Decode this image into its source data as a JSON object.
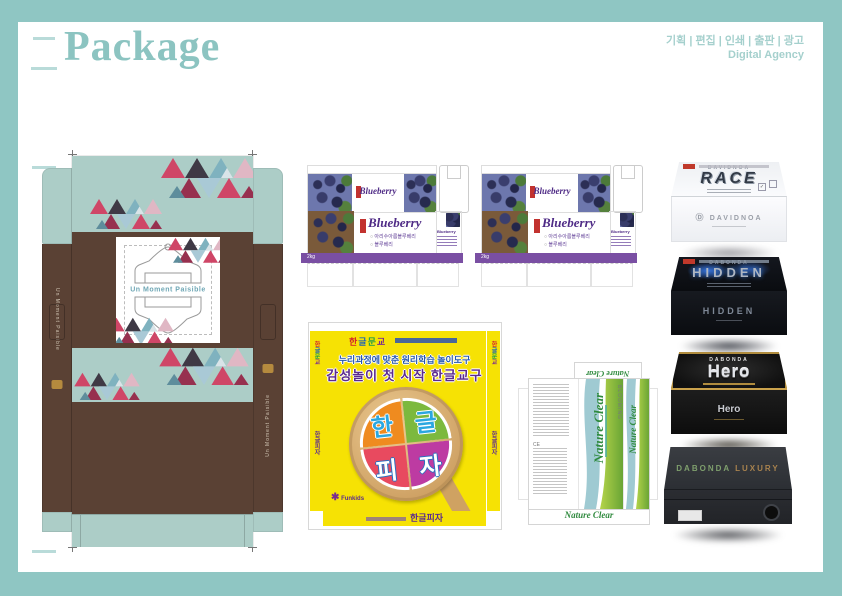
{
  "colors": {
    "frame_teal": "#8fc6c3",
    "dieline_brown": "#5a4134",
    "dieline_mint": "#accdc7",
    "blueberry_purple": "#4f2b86",
    "stripe_purple": "#7a4fa3",
    "pizza_yellow": "#f6e204",
    "nature_green": "#2f8a3e"
  },
  "header": {
    "title": "Package",
    "services": "기획 | 편집 | 인쇄 | 출판 | 광고",
    "agency": "Digital Agency"
  },
  "moment_package": {
    "center_text": "Un Moment Paisible",
    "left_flap_text": "Un Moment Paisible",
    "right_flap_text": "Un Moment Paisible"
  },
  "blueberry_package": {
    "top_title": "Blueberry",
    "title": "Blueberry",
    "side_title": "Blueberry",
    "options": [
      "아리수아름블루베리",
      "블루베리"
    ],
    "weight": "2kg"
  },
  "hangul_pizza": {
    "brand": "한글문교",
    "line1": "누리과정에 맞춘 원리학습 놀이도구",
    "line2": "감성놀이 첫 시작 한글교구",
    "slices": [
      "한",
      "글",
      "피",
      "자"
    ],
    "maker": "Funkids",
    "footer": "한글피자",
    "side_text": "한글피자"
  },
  "nature_clear": {
    "title": "Nature Clear",
    "brand": "BLOOMING",
    "ce_mark": "CE"
  },
  "product_boxes": [
    {
      "name": "race",
      "brand": "DAVIDNOA",
      "title": "RACE",
      "front": "DAVIDNOA"
    },
    {
      "name": "hidden",
      "brand": "DABONDA",
      "title": "HIDDEN",
      "front": "HIDDEN"
    },
    {
      "name": "hero",
      "brand": "DABONDA",
      "title": "Hero",
      "front": "Hero"
    },
    {
      "name": "luxury",
      "brand": "DABONDA",
      "title": "LUXURY",
      "front": ""
    }
  ]
}
